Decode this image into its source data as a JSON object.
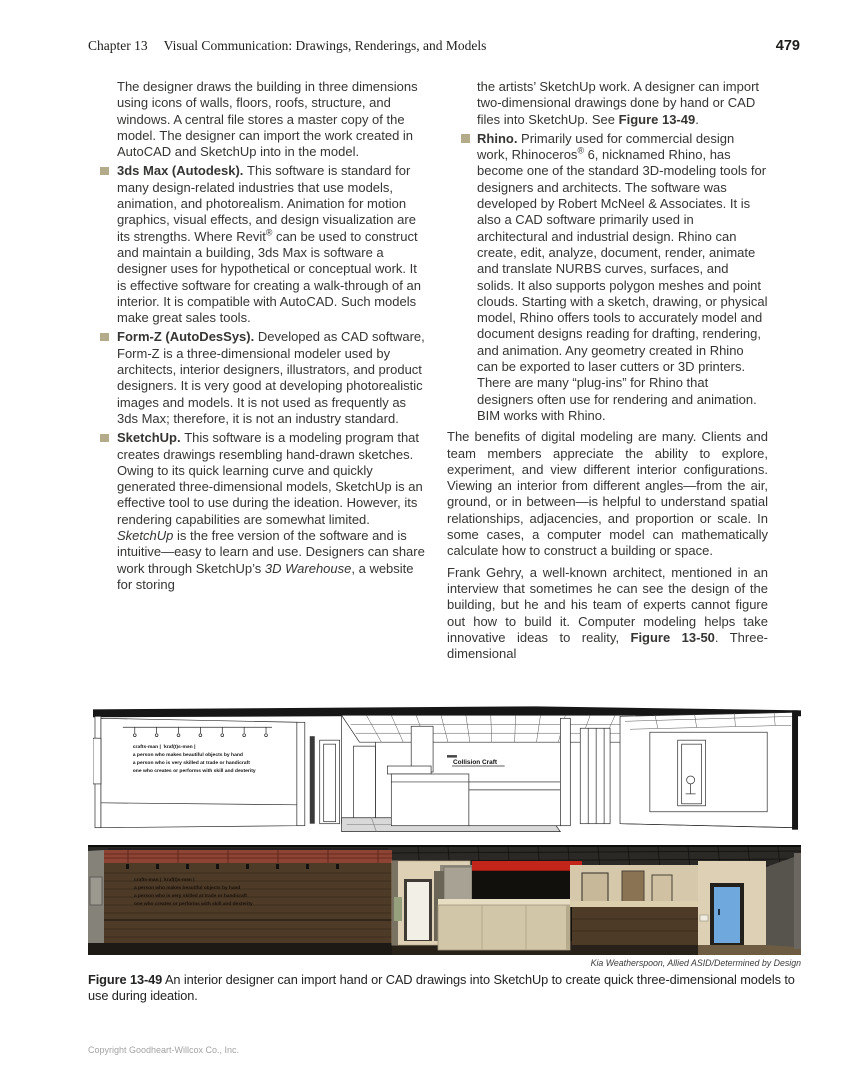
{
  "header": {
    "chapter": "Chapter 13",
    "title": "Visual Communication: Drawings, Renderings, and Models",
    "page_number": "479"
  },
  "left_column": {
    "intro": "The designer draws the building in three dimensions using icons of walls, floors, roofs, structure, and windows. A central file stores a master copy of the model. The designer can import the work created in AutoCAD and SketchUp into in the model.",
    "bullets": [
      {
        "segments": [
          {
            "b": "3ds Max (Autodesk). "
          },
          {
            "t": "This software is standard for many design-related industries that use models, animation, and photorealism. Animation for motion graphics, visual effects, and design visualization are its strengths. Where Revit"
          },
          {
            "s": "®"
          },
          {
            "t": " can be used to construct and maintain a building, 3ds Max is software a designer uses for hypothetical or conceptual work. It is effective software for creating a walk-through of an interior. It is compatible with AutoCAD. Such models make great sales tools."
          }
        ]
      },
      {
        "segments": [
          {
            "b": "Form-Z (AutoDesSys). "
          },
          {
            "t": "Developed as CAD software, Form-Z is a three-dimensional modeler used by architects, interior designers, illustrators, and product designers. It is very good at developing photorealistic images and models. It is not used as frequently as 3ds Max; therefore, it is not an industry standard."
          }
        ]
      },
      {
        "segments": [
          {
            "b": "SketchUp. "
          },
          {
            "t": "This software is a modeling program that creates drawings resembling hand-drawn sketches. Owing to its quick learning curve and quickly generated three-dimensional models, SketchUp is an effective tool to use during the ideation. However, its rendering capabilities are somewhat limited. "
          },
          {
            "i": "SketchUp"
          },
          {
            "t": " is the free version of the software and is intuitive—easy to learn and use. Designers can share work through SketchUp’s "
          },
          {
            "i": "3D Warehouse"
          },
          {
            "t": ", a website for storing"
          }
        ]
      }
    ]
  },
  "right_column": {
    "continuation_segments": [
      {
        "t": "the artists’ SketchUp work. A designer can import two-dimensional drawings done by hand or CAD files into SketchUp. See "
      },
      {
        "b": "Figure 13-49"
      },
      {
        "t": "."
      }
    ],
    "bullets": [
      {
        "segments": [
          {
            "b": "Rhino. "
          },
          {
            "t": "Primarily used for commercial design work, Rhinoceros"
          },
          {
            "s": "®"
          },
          {
            "t": " 6, nicknamed Rhino, has become one of the standard 3D-modeling tools for designers and architects. The software was developed by Robert McNeel & Associates. It is also a CAD software primarily used in architectural and industrial design. Rhino can create, edit, analyze, document, render, animate and translate NURBS curves, surfaces, and solids. It also supports polygon meshes and point clouds. Starting with a sketch, drawing, or physical model, Rhino offers tools to accurately model and document designs reading for drafting, rendering, and animation. Any geometry created in Rhino can be exported to laser cutters or 3D printers. There are many “plug-ins” for Rhino that designers often use for rendering and animation. BIM works with Rhino."
          }
        ]
      }
    ],
    "paragraphs": [
      [
        {
          "t": "The benefits of digital modeling are many. Clients and team members appreciate the ability to explore, experiment, and view different interior configurations. Viewing an interior from different angles—from the air, ground, or in between—is helpful to understand spatial relationships, adjacencies, and proportion or scale. In some cases, a computer model can mathematically calculate how to construct a building or space."
        }
      ],
      [
        {
          "t": "Frank Gehry, a well-known architect, mentioned in an interview that sometimes he can see the design of the building, but he and his team of experts cannot figure out how to build it. Computer modeling helps take innovative ideas to reality, "
        },
        {
          "b": "Figure 13-50"
        },
        {
          "t": ". Three-dimensional"
        }
      ]
    ]
  },
  "figure": {
    "definition_lines": [
      "crafts-man | ˈkraf(t)s-mən |",
      "a person who makes beautiful objects by hand",
      "a person who is very skilled at trade or handicraft",
      "one who creates or performs with skill and dexterity"
    ],
    "sign_text": "Collision Craft",
    "credit": "Kia Weatherspoon, Allied ASID/Determined by Design",
    "caption_label": "Figure 13-49",
    "caption_text": " An interior designer can import hand or CAD drawings into SketchUp to create quick three-dimensional models to use during ideation."
  },
  "footer": {
    "copyright": "Copyright Goodheart-Willcox Co., Inc."
  },
  "colors": {
    "bullet": "#b3ab8a",
    "accent_red": "#c4251b",
    "door_blue": "#6fa8dc",
    "wood": "#4d3a27",
    "beige": "#ddd0b4"
  }
}
